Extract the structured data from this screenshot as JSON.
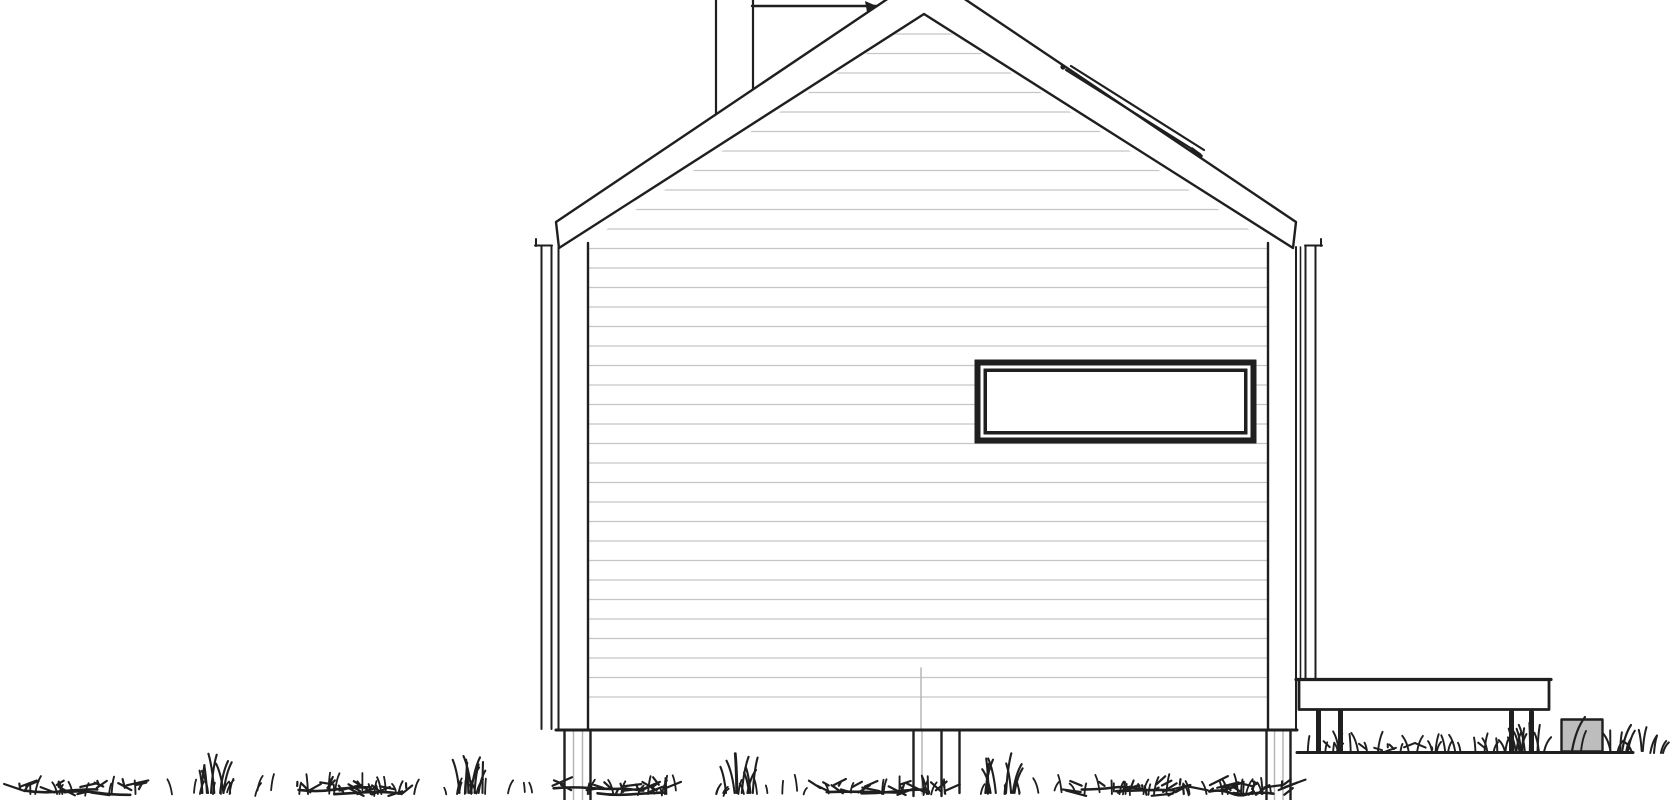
{
  "meta": {
    "title": "Gable-end house elevation line drawing",
    "description": "Black-and-white architectural side elevation of a small gabled cabin on post foundations, with horizontal siding, one wide ribbon window, a ridge/chimney line behind the roof, a snow-guard strip on the right roof slope, an attached deck platform at right, a small concrete block, and hand-drawn grass along two ground lines."
  },
  "colors": {
    "background": "#ffffff",
    "line": "#1f1f1f",
    "siding_line": "#c5c5c5",
    "faint_line": "#b2b2b2",
    "block_fill": "#bdbdbd",
    "paper_fill": "#ffffff"
  },
  "parts": {
    "roof": "gabled roof with fascia band",
    "chimney": "chimney / ridge line behind roof",
    "snow_guard": "snow guard strip on right roof slope",
    "siding": "horizontal lap siding",
    "window": "wide fixed ribbon window",
    "corner_trim_left": "left corner trim board",
    "corner_trim_right": "right corner trim board",
    "downspout_left": "left eave drip board",
    "downspout_right": "right eave drip board",
    "foundation_posts": "foundation posts below floor line",
    "deck": "attached deck platform",
    "deck_posts": "deck support posts",
    "concrete_block": "concrete block on grade",
    "grass_bottom": "grass band at lower ground line",
    "grass_terrace": "grass on upper right ground line"
  }
}
